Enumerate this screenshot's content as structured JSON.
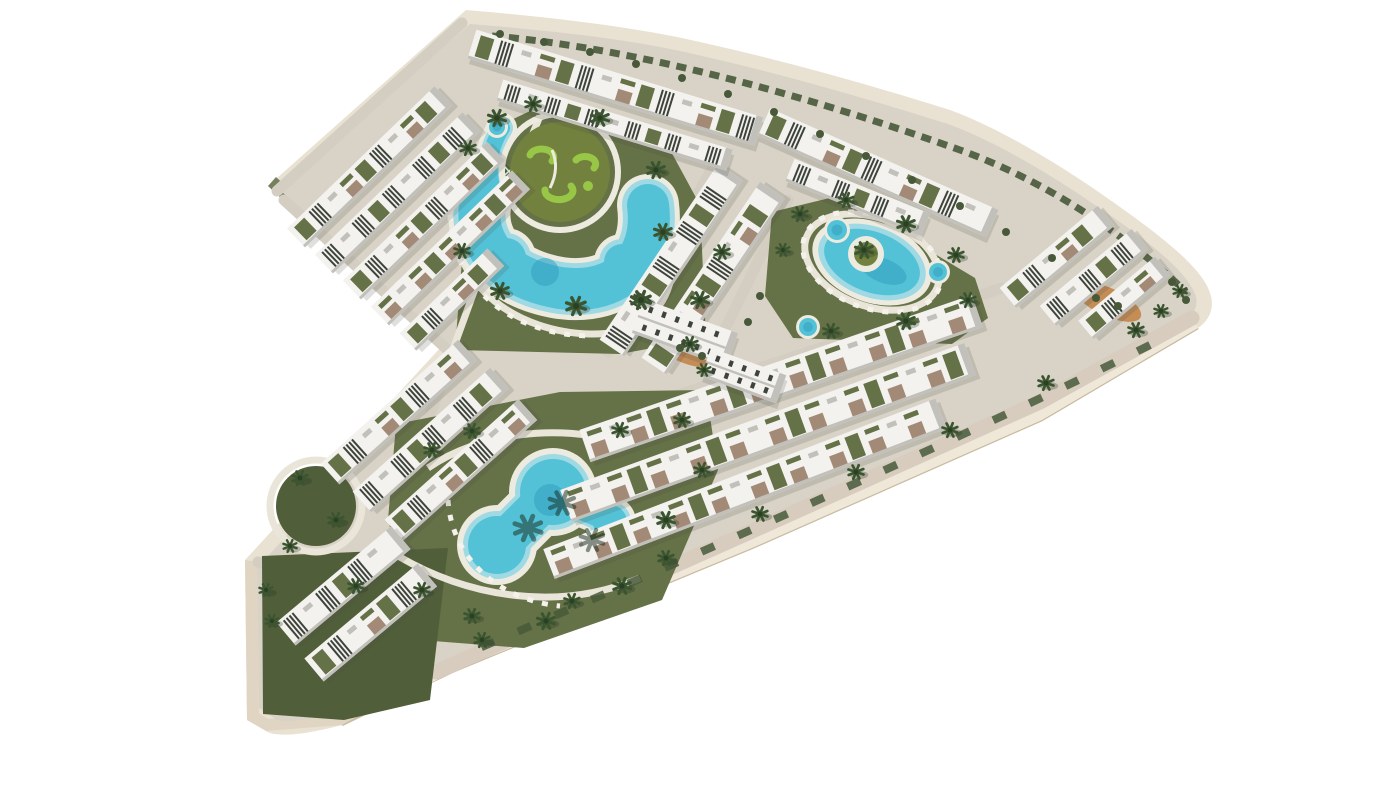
{
  "meta": {
    "type": "3d-architectural-aerial-render",
    "description": "Aerial 3D rendering of a chevron-shaped coastal residential complex with white terraced apartment blocks, landscaped olive-green gardens, palm trees, a lagoon pool with putting-green island, an oval pool with palm island, an organic multi-lobe pool and round spa pools, isolated on a white background"
  },
  "colors": {
    "bg": "#ffffff",
    "deck": "#d8d3c6",
    "road": "#d3cec1",
    "road_warm": "#d8ccbf",
    "edge_cream": "#e9e2d2",
    "edge_face": "#efe8d8",
    "edge_line": "#c9bba2",
    "edge_dark": "#e0d5c2",
    "side_olive": "#75805f",
    "grass": "#657147",
    "grass_dark": "#515e3a",
    "court": "#45613e",
    "island": "#72813e",
    "squiggle": "#98c747",
    "pool": "#54c2d6",
    "pool_light": "#9fd9e4",
    "pool_deep": "#2f9cbd",
    "coping": "#edebdf",
    "path_white": "#e9e5d9",
    "lounger": "#f4f2ea",
    "building": "#f3f2ee",
    "bshade": "#c2c0ba",
    "louver": "#3e443c",
    "terrace": "#a28a77",
    "palm": "#3c5531",
    "palm_dark": "#2b4023",
    "bush": "#48593a",
    "orange": "#c28549"
  },
  "scene": {
    "pool_count": 3,
    "spa_pool_count": 4,
    "building_rows": [
      [
        296,
        238,
        205,
        26,
        -44,
        "mixed"
      ],
      [
        324,
        264,
        205,
        26,
        -44,
        "louver"
      ],
      [
        352,
        290,
        200,
        26,
        -44,
        "mixed"
      ],
      [
        380,
        316,
        196,
        26,
        -44,
        "terrace"
      ],
      [
        408,
        342,
        122,
        24,
        -44,
        "mixed"
      ],
      [
        612,
        348,
        212,
        30,
        -56,
        "louver"
      ],
      [
        654,
        366,
        212,
        30,
        -56,
        "mixed"
      ],
      [
        472,
        44,
        300,
        30,
        17,
        "mixed"
      ],
      [
        500,
        90,
        240,
        22,
        17,
        "louver"
      ],
      [
        764,
        122,
        250,
        30,
        24,
        "mixed"
      ],
      [
        790,
        170,
        146,
        24,
        22,
        "louver"
      ],
      [
        1008,
        298,
        128,
        26,
        -40,
        "mixed"
      ],
      [
        1048,
        316,
        120,
        26,
        -40,
        "louver"
      ],
      [
        1086,
        330,
        100,
        24,
        -40,
        "mixed"
      ],
      [
        585,
        446,
        415,
        34,
        -19,
        "terrace"
      ],
      [
        566,
        506,
        430,
        34,
        -20,
        "terrace"
      ],
      [
        549,
        564,
        420,
        32,
        -21,
        "terrace"
      ],
      [
        330,
        474,
        185,
        28,
        -42,
        "mixed"
      ],
      [
        362,
        502,
        185,
        28,
        -42,
        "louver"
      ],
      [
        394,
        530,
        180,
        28,
        -42,
        "mixed"
      ],
      [
        286,
        634,
        150,
        30,
        -40,
        "louver"
      ],
      [
        314,
        670,
        148,
        30,
        -40,
        "mixed"
      ],
      [
        638,
        316,
        100,
        36,
        20,
        "box"
      ],
      [
        706,
        362,
        80,
        30,
        20,
        "box"
      ]
    ],
    "palms": [
      [
        497,
        118,
        9
      ],
      [
        468,
        148,
        8
      ],
      [
        533,
        104,
        8
      ],
      [
        600,
        118,
        9
      ],
      [
        656,
        170,
        9
      ],
      [
        663,
        232,
        9
      ],
      [
        641,
        300,
        10
      ],
      [
        576,
        306,
        10
      ],
      [
        500,
        291,
        9
      ],
      [
        462,
        251,
        8
      ],
      [
        700,
        300,
        9
      ],
      [
        722,
        252,
        8
      ],
      [
        690,
        344,
        8
      ],
      [
        704,
        370,
        7
      ],
      [
        800,
        214,
        8
      ],
      [
        846,
        200,
        8
      ],
      [
        906,
        224,
        9
      ],
      [
        956,
        255,
        8
      ],
      [
        968,
        300,
        8
      ],
      [
        906,
        321,
        9
      ],
      [
        831,
        331,
        8
      ],
      [
        783,
        250,
        7
      ],
      [
        864,
        250,
        9
      ],
      [
        1136,
        330,
        8
      ],
      [
        1046,
        383,
        8
      ],
      [
        950,
        430,
        8
      ],
      [
        856,
        472,
        8
      ],
      [
        760,
        514,
        8
      ],
      [
        666,
        558,
        8
      ],
      [
        572,
        601,
        8
      ],
      [
        482,
        640,
        8
      ],
      [
        1180,
        291,
        7
      ],
      [
        1161,
        311,
        7
      ],
      [
        432,
        450,
        8
      ],
      [
        472,
        431,
        8
      ],
      [
        620,
        430,
        8
      ],
      [
        682,
        420,
        8
      ],
      [
        702,
        470,
        8
      ],
      [
        666,
        520,
        9
      ],
      [
        622,
        586,
        9
      ],
      [
        546,
        621,
        9
      ],
      [
        472,
        616,
        8
      ],
      [
        422,
        590,
        8
      ],
      [
        300,
        478,
        8
      ],
      [
        336,
        520,
        8
      ],
      [
        290,
        546,
        7
      ],
      [
        266,
        590,
        7
      ],
      [
        356,
        586,
        8
      ],
      [
        272,
        621,
        7
      ]
    ],
    "shadow_palms": [
      [
        528,
        528,
        14
      ],
      [
        562,
        503,
        13
      ],
      [
        592,
        540,
        12
      ]
    ],
    "bushes": [
      [
        680,
        348,
        4
      ],
      [
        702,
        356,
        4
      ],
      [
        1096,
        298,
        4
      ],
      [
        1118,
        306,
        4
      ],
      [
        1172,
        282,
        4
      ],
      [
        1186,
        300,
        4
      ],
      [
        960,
        206,
        4
      ],
      [
        912,
        180,
        4
      ],
      [
        866,
        156,
        4
      ],
      [
        820,
        134,
        4
      ],
      [
        774,
        112,
        4
      ],
      [
        728,
        94,
        4
      ],
      [
        682,
        78,
        4
      ],
      [
        636,
        64,
        4
      ],
      [
        590,
        52,
        4
      ],
      [
        544,
        42,
        4
      ],
      [
        500,
        34,
        4
      ],
      [
        1006,
        232,
        4
      ],
      [
        1052,
        258,
        4
      ],
      [
        760,
        296,
        4
      ],
      [
        748,
        322,
        4
      ]
    ],
    "spa_pools": [
      [
        837,
        230,
        10
      ],
      [
        938,
        272,
        9
      ],
      [
        808,
        327,
        9
      ],
      [
        497,
        127,
        8
      ]
    ]
  }
}
